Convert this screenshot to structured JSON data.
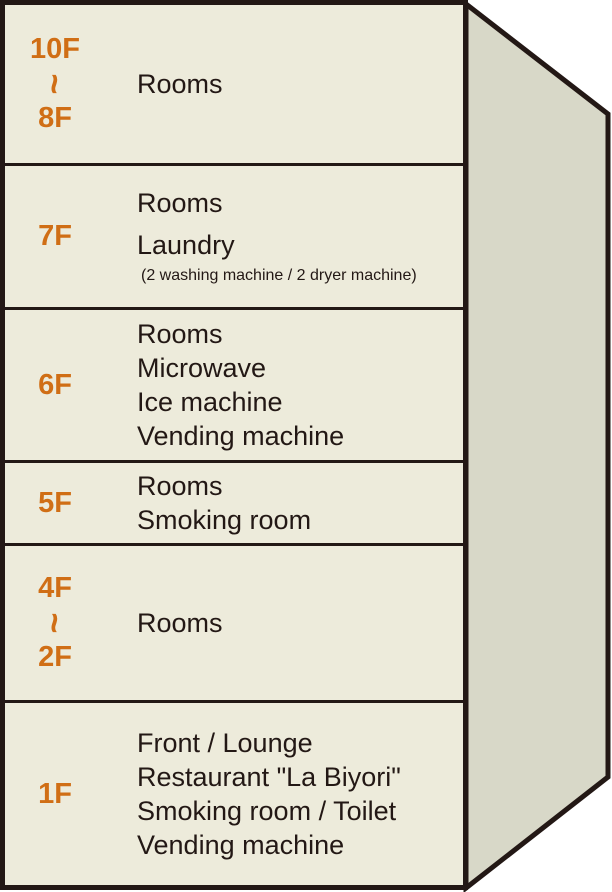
{
  "diagram": {
    "name": "Hotel floor guide",
    "colors": {
      "front_face": "#EDEBDB",
      "side_face": "#D8D8C8",
      "outline": "#231815",
      "floor_label": "#D06E15",
      "text": "#231815"
    },
    "floors": [
      {
        "id": "10F-8F",
        "label": [
          "10F",
          "~",
          "8F"
        ],
        "height_px": 161,
        "facilities": [
          {
            "text": "Rooms",
            "size": "main"
          }
        ]
      },
      {
        "id": "7F",
        "label": [
          "7F"
        ],
        "height_px": 144,
        "facilities": [
          {
            "text": "Rooms",
            "size": "main"
          },
          {
            "text": "Laundry",
            "size": "main"
          },
          {
            "text": "(2 washing machine / 2 dryer machine)",
            "size": "small"
          }
        ]
      },
      {
        "id": "6F",
        "label": [
          "6F"
        ],
        "height_px": 153,
        "facilities": [
          {
            "text": "Rooms",
            "size": "main"
          },
          {
            "text": "Microwave",
            "size": "main"
          },
          {
            "text": "Ice machine",
            "size": "main"
          },
          {
            "text": "Vending machine",
            "size": "main"
          }
        ]
      },
      {
        "id": "5F",
        "label": [
          "5F"
        ],
        "height_px": 83,
        "facilities": [
          {
            "text": "Rooms",
            "size": "main"
          },
          {
            "text": "Smoking room",
            "size": "main"
          }
        ]
      },
      {
        "id": "4F-2F",
        "label": [
          "4F",
          "~",
          "2F"
        ],
        "height_px": 157,
        "facilities": [
          {
            "text": "Rooms",
            "size": "main"
          }
        ]
      },
      {
        "id": "1F",
        "label": [
          "1F"
        ],
        "height_px": 182,
        "facilities": [
          {
            "text": "Front / Lounge",
            "size": "main"
          },
          {
            "text": "Restaurant \"La Biyori\"",
            "size": "main"
          },
          {
            "text": "Smoking room / Toilet",
            "size": "main"
          },
          {
            "text": "Vending machine",
            "size": "main"
          }
        ]
      }
    ]
  }
}
